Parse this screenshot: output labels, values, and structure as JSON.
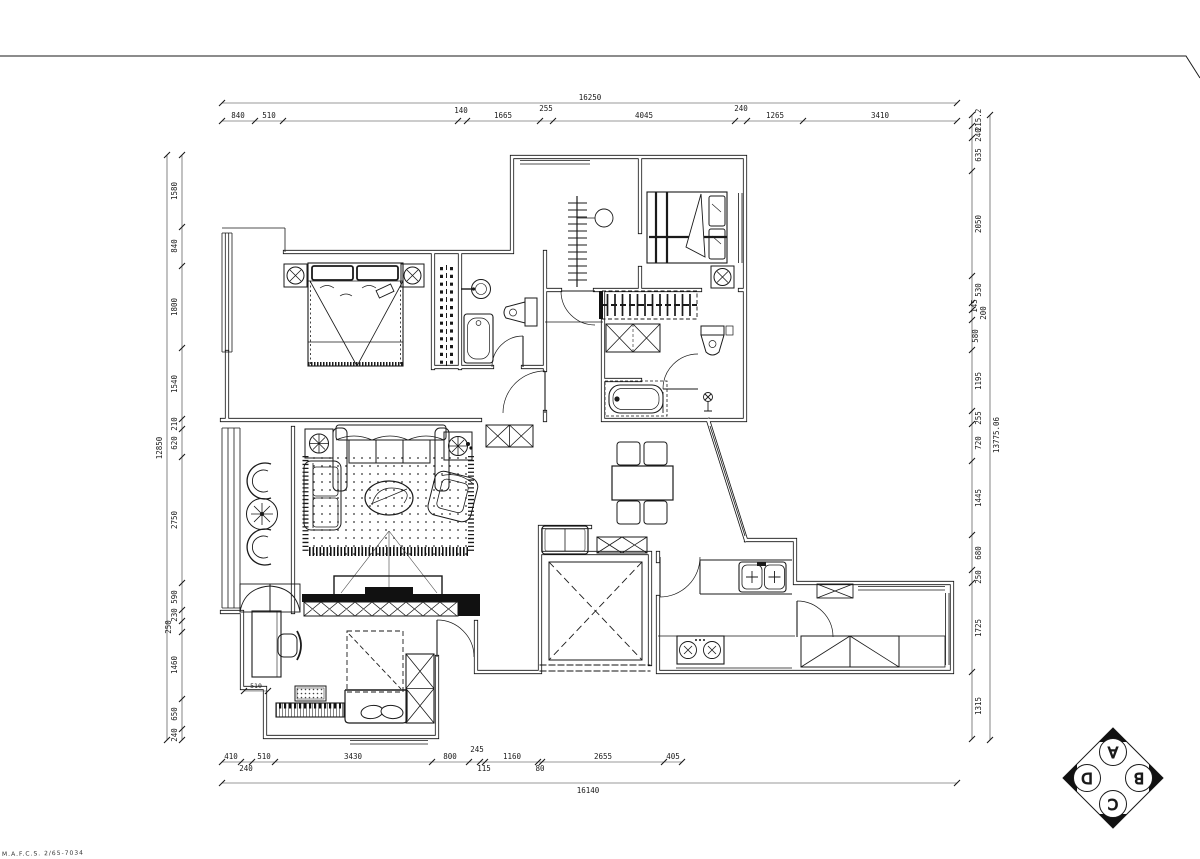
{
  "sheet": {
    "illegible_note": "M.A.F.C.S. 2/65-7034"
  },
  "dimensions": {
    "top": {
      "overall": "16250",
      "segments": [
        "840",
        "510",
        "140",
        "1665",
        "255",
        "4045",
        "240",
        "1265",
        "3410"
      ]
    },
    "bottom": {
      "overall": "16140",
      "segments": [
        "410",
        "240",
        "510",
        "3430",
        "800",
        "245",
        "115",
        "1160",
        "80",
        "2655",
        "405"
      ]
    },
    "left": {
      "overall": "12850",
      "segments": [
        "1580",
        "840",
        "1800",
        "1540",
        "210",
        "620",
        "2750",
        "590",
        "230",
        "250",
        "1460",
        "650",
        "240"
      ]
    },
    "right": {
      "overall": "13775.06",
      "segments": [
        "215.2",
        "240",
        "635",
        "2050",
        "530",
        "145",
        "200",
        "580",
        "1195",
        "255",
        "720",
        "1445",
        "680",
        "250",
        "1725",
        "1315"
      ]
    },
    "interior": {
      "study_niche": "510"
    }
  },
  "elevation_marker": {
    "letters": {
      "top": "A",
      "right": "B",
      "bottom": "C",
      "left": "D"
    }
  }
}
